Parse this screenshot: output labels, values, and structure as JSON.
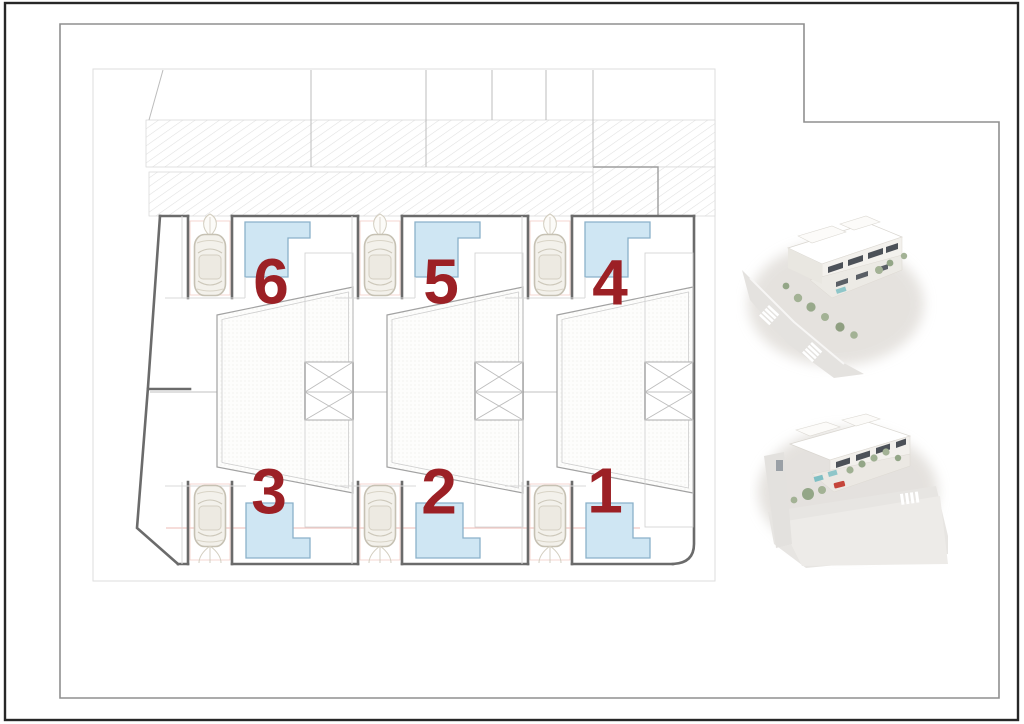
{
  "plan": {
    "type": "architectural site plan",
    "plots": [
      {
        "id": "plot-6",
        "label": "6"
      },
      {
        "id": "plot-5",
        "label": "5"
      },
      {
        "id": "plot-4",
        "label": "4"
      },
      {
        "id": "plot-3",
        "label": "3"
      },
      {
        "id": "plot-2",
        "label": "2"
      },
      {
        "id": "plot-1",
        "label": "1"
      }
    ],
    "colors": {
      "plot_number": "#9c2025",
      "pool_fill": "#cfe6f3",
      "pool_edge": "#8ab1c9",
      "boundary_line": "#6b6b6b",
      "hatch_line": "#e0e0e0",
      "sheet_border": "#8f8f8f",
      "outer_border": "#272727"
    },
    "icons": [
      "car-icon",
      "pool-shape",
      "stair-shaft-icon",
      "plant-icon",
      "hatched-road"
    ]
  },
  "renders": [
    {
      "id": "render-top",
      "name": "aerial-3d-render-street-corner"
    },
    {
      "id": "render-bottom",
      "name": "aerial-3d-render-rear-view"
    }
  ]
}
